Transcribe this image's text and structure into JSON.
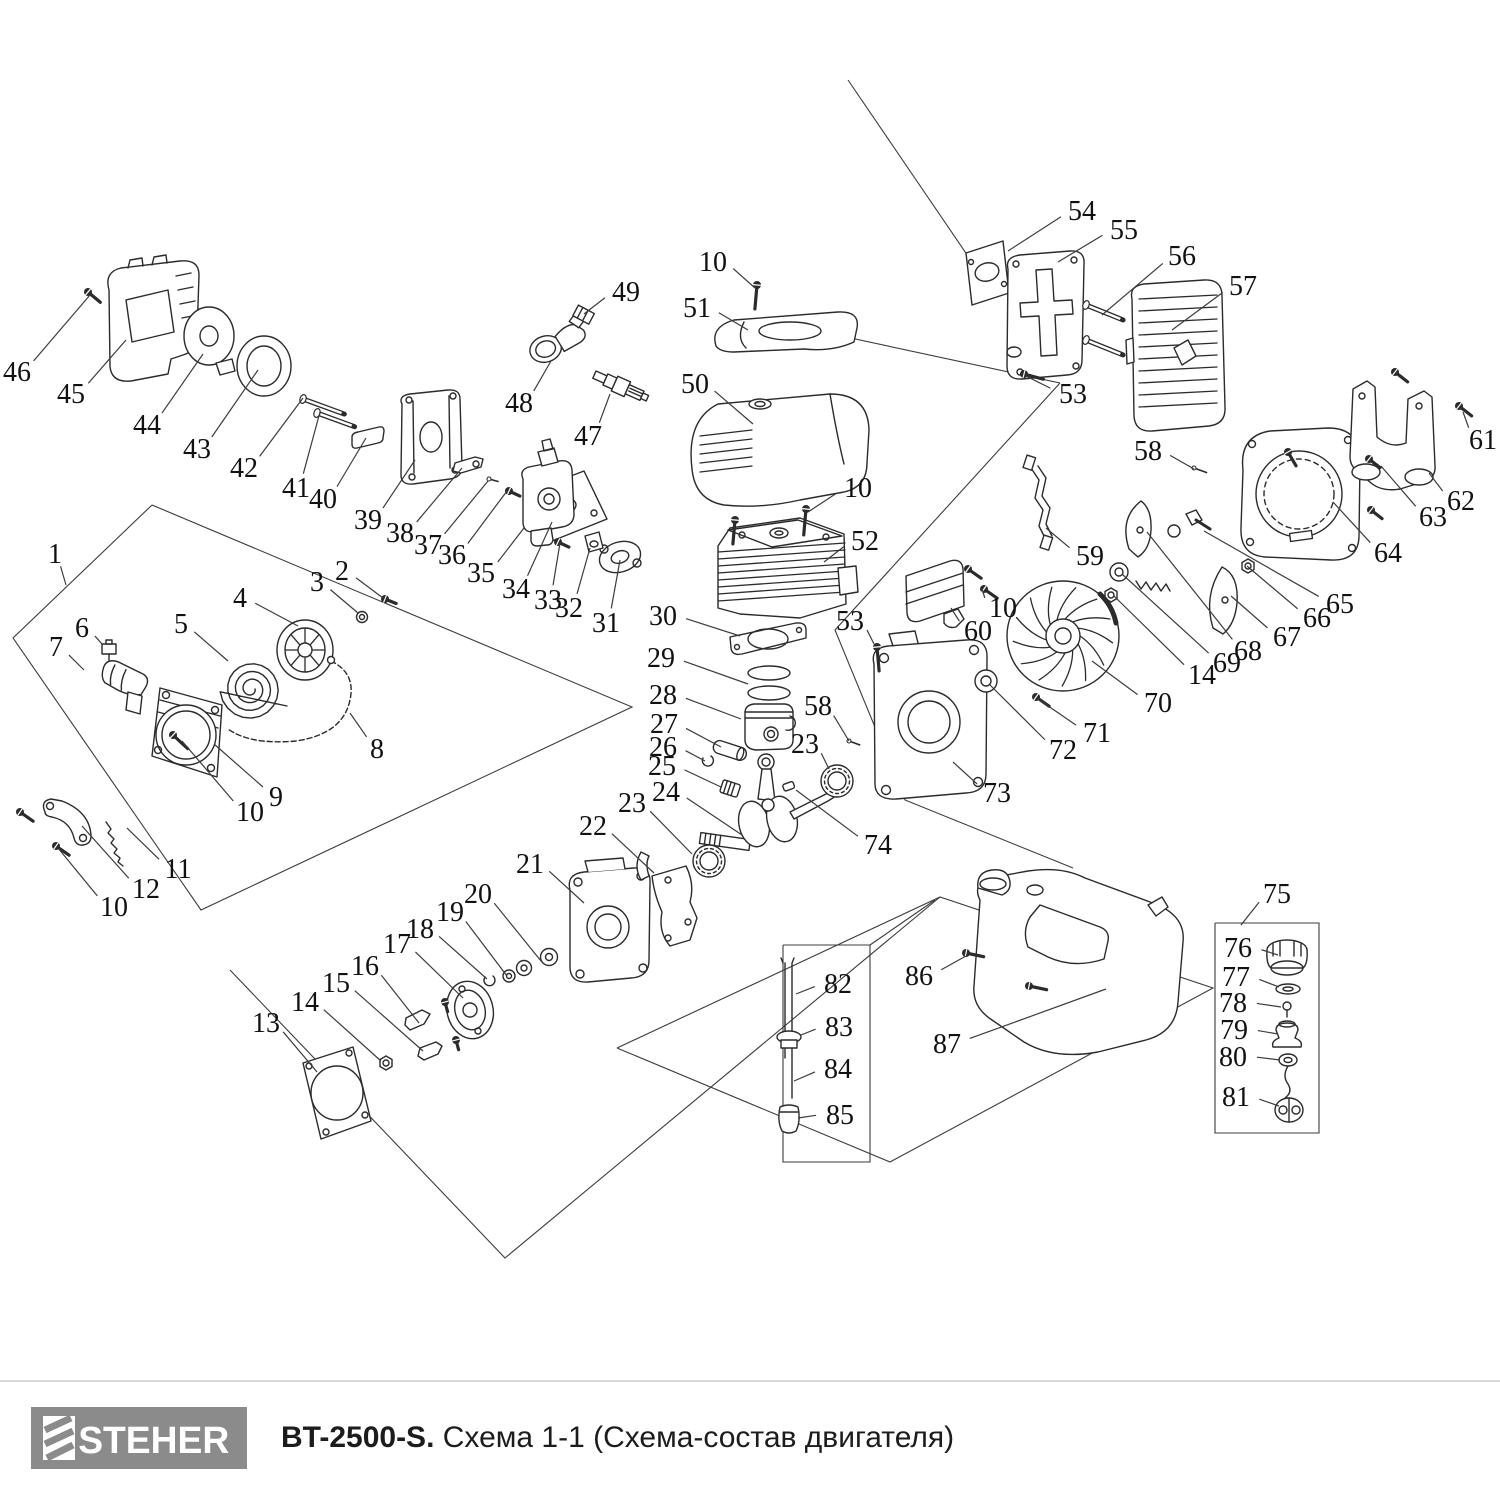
{
  "footer": {
    "brand": "STEHER",
    "model": "BT-2500-S.",
    "scheme": "Схема 1-1 (Схема-состав двигателя)"
  },
  "colors": {
    "ink": "#2b2b2b",
    "leader": "#3c3c3c",
    "logo_gray": "#8b8b8b",
    "divider": "#d9d9d9"
  },
  "diagram": {
    "labels": [
      [
        "46",
        17,
        371,
        90,
        295
      ],
      [
        "45",
        71,
        393,
        126,
        340
      ],
      [
        "44",
        147,
        424,
        203,
        354
      ],
      [
        "43",
        197,
        448,
        258,
        370
      ],
      [
        "42",
        244,
        467,
        303,
        398
      ],
      [
        "41",
        296,
        487,
        320,
        412
      ],
      [
        "40",
        323,
        498,
        366,
        438
      ],
      [
        "39",
        368,
        519,
        415,
        460
      ],
      [
        "38",
        400,
        532,
        462,
        468
      ],
      [
        "37",
        428,
        544,
        488,
        481
      ],
      [
        "36",
        452,
        554,
        507,
        491
      ],
      [
        "35",
        481,
        572,
        524,
        528
      ],
      [
        "34",
        516,
        588,
        552,
        522
      ],
      [
        "33",
        548,
        599,
        560,
        543
      ],
      [
        "32",
        569,
        607,
        590,
        548
      ],
      [
        "31",
        606,
        622,
        620,
        560
      ],
      [
        "1",
        55,
        553,
        66,
        585
      ],
      [
        "49",
        626,
        291,
        584,
        314
      ],
      [
        "48",
        519,
        402,
        551,
        361
      ],
      [
        "47",
        588,
        435,
        610,
        394
      ],
      [
        "10",
        713,
        261,
        755,
        288
      ],
      [
        "51",
        697,
        307,
        748,
        330
      ],
      [
        "50",
        695,
        383,
        753,
        424
      ],
      [
        "10",
        858,
        487,
        808,
        512
      ],
      [
        "52",
        865,
        540,
        824,
        562
      ],
      [
        "54",
        1082,
        210,
        1008,
        251
      ],
      [
        "55",
        1124,
        229,
        1058,
        262
      ],
      [
        "56",
        1182,
        255,
        1102,
        315
      ],
      [
        "57",
        1243,
        285,
        1172,
        330
      ],
      [
        "53",
        1073,
        393,
        1026,
        376
      ],
      [
        "58",
        1148,
        450,
        1194,
        469
      ],
      [
        "61",
        1483,
        439,
        1463,
        412
      ],
      [
        "62",
        1461,
        500,
        1429,
        473
      ],
      [
        "63",
        1433,
        516,
        1381,
        466
      ],
      [
        "64",
        1388,
        552,
        1333,
        502
      ],
      [
        "65",
        1340,
        603,
        1204,
        531
      ],
      [
        "66",
        1317,
        617,
        1247,
        566
      ],
      [
        "67",
        1287,
        636,
        1231,
        596
      ],
      [
        "68",
        1248,
        650,
        1147,
        532
      ],
      [
        "69",
        1227,
        662,
        1122,
        574
      ],
      [
        "14",
        1202,
        674,
        1114,
        596
      ],
      [
        "70",
        1158,
        702,
        1092,
        661
      ],
      [
        "71",
        1097,
        732,
        1038,
        699
      ],
      [
        "72",
        1063,
        749,
        989,
        684
      ],
      [
        "73",
        997,
        792,
        953,
        762
      ],
      [
        "74",
        878,
        844,
        796,
        790
      ],
      [
        "59",
        1090,
        555,
        1046,
        528
      ],
      [
        "60",
        978,
        630,
        951,
        608
      ],
      [
        "10",
        1003,
        607,
        982,
        589
      ],
      [
        "53",
        850,
        620,
        874,
        644
      ],
      [
        "58",
        818,
        705,
        849,
        741
      ],
      [
        "23",
        805,
        743,
        829,
        769
      ],
      [
        "6",
        82,
        627,
        102,
        644
      ],
      [
        "7",
        56,
        646,
        84,
        670
      ],
      [
        "5",
        181,
        623,
        228,
        661
      ],
      [
        "4",
        240,
        597,
        298,
        626
      ],
      [
        "3",
        317,
        581,
        358,
        613
      ],
      [
        "2",
        342,
        570,
        383,
        598
      ],
      [
        "8",
        377,
        748,
        350,
        713
      ],
      [
        "9",
        276,
        796,
        214,
        744
      ],
      [
        "10",
        250,
        811,
        182,
        741
      ],
      [
        "11",
        178,
        868,
        127,
        828
      ],
      [
        "12",
        146,
        888,
        82,
        826
      ],
      [
        "10",
        114,
        906,
        58,
        848
      ],
      [
        "30",
        663,
        615,
        740,
        636
      ],
      [
        "29",
        661,
        657,
        748,
        684
      ],
      [
        "28",
        663,
        694,
        741,
        719
      ],
      [
        "27",
        664,
        723,
        721,
        747
      ],
      [
        "26",
        663,
        746,
        705,
        761
      ],
      [
        "25",
        662,
        765,
        721,
        787
      ],
      [
        "24",
        666,
        791,
        742,
        835
      ],
      [
        "23",
        632,
        802,
        692,
        854
      ],
      [
        "22",
        593,
        825,
        654,
        873
      ],
      [
        "13",
        266,
        1022,
        317,
        1072
      ],
      [
        "14",
        305,
        1001,
        381,
        1061
      ],
      [
        "15",
        336,
        982,
        423,
        1051
      ],
      [
        "16",
        365,
        965,
        419,
        1023
      ],
      [
        "17",
        397,
        943,
        463,
        998
      ],
      [
        "18",
        420,
        928,
        487,
        979
      ],
      [
        "19",
        450,
        911,
        507,
        976
      ],
      [
        "20",
        478,
        893,
        541,
        961
      ],
      [
        "21",
        530,
        863,
        584,
        903
      ],
      [
        "86",
        919,
        975,
        966,
        956
      ],
      [
        "87",
        947,
        1043,
        1106,
        989
      ],
      [
        "82",
        838,
        983,
        796,
        994
      ],
      [
        "83",
        839,
        1026,
        801,
        1035
      ],
      [
        "84",
        838,
        1068,
        794,
        1081
      ],
      [
        "85",
        840,
        1114,
        798,
        1118
      ],
      [
        "75",
        1277,
        893,
        1241,
        925
      ],
      [
        "76",
        1238,
        947,
        1278,
        955
      ],
      [
        "77",
        1236,
        976,
        1279,
        987
      ],
      [
        "78",
        1233,
        1002,
        1281,
        1007
      ],
      [
        "79",
        1234,
        1029,
        1278,
        1034
      ],
      [
        "80",
        1233,
        1056,
        1280,
        1060
      ],
      [
        "81",
        1236,
        1096,
        1279,
        1106
      ]
    ],
    "screws": [
      [
        88,
        292,
        40,
        16,
        "h"
      ],
      [
        303,
        399,
        20,
        44,
        "r"
      ],
      [
        317,
        413,
        20,
        40,
        "r"
      ],
      [
        757,
        285,
        95,
        24,
        "h"
      ],
      [
        806,
        509,
        95,
        26,
        "h"
      ],
      [
        735,
        520,
        95,
        24,
        "h"
      ],
      [
        968,
        569,
        35,
        16,
        "h"
      ],
      [
        984,
        589,
        35,
        16,
        "h"
      ],
      [
        877,
        647,
        85,
        24,
        "h"
      ],
      [
        1024,
        374,
        15,
        20,
        "h"
      ],
      [
        1086,
        305,
        22,
        40,
        "r"
      ],
      [
        1086,
        340,
        22,
        40,
        "r"
      ],
      [
        1194,
        468,
        20,
        14,
        "p"
      ],
      [
        849,
        741,
        20,
        12,
        "p"
      ],
      [
        489,
        479,
        15,
        10,
        "p"
      ],
      [
        509,
        491,
        25,
        12,
        "h"
      ],
      [
        558,
        542,
        25,
        12,
        "h"
      ],
      [
        1395,
        372,
        38,
        16,
        "h"
      ],
      [
        1459,
        406,
        38,
        16,
        "h"
      ],
      [
        1369,
        459,
        38,
        14,
        "h"
      ],
      [
        1371,
        510,
        38,
        14,
        "h"
      ],
      [
        1288,
        452,
        60,
        16,
        "h"
      ],
      [
        1036,
        697,
        35,
        16,
        "h"
      ],
      [
        56,
        846,
        35,
        16,
        "h"
      ],
      [
        20,
        812,
        35,
        16,
        "h"
      ],
      [
        173,
        735,
        43,
        20,
        "h"
      ],
      [
        385,
        599,
        22,
        12,
        "h"
      ],
      [
        966,
        953,
        12,
        18,
        "h"
      ],
      [
        1029,
        986,
        12,
        18,
        "h"
      ],
      [
        445,
        1002,
        75,
        10,
        "h"
      ],
      [
        456,
        1040,
        75,
        10,
        "h"
      ]
    ],
    "panels": [
      [
        [
          152,
          505
        ],
        [
          13,
          638
        ],
        [
          201,
          910
        ],
        [
          632,
          707
        ],
        [
          152,
          505
        ]
      ],
      [
        [
          230,
          970
        ],
        [
          505,
          1258
        ],
        [
          940,
          897
        ]
      ],
      [
        [
          1060,
          383
        ],
        [
          835,
          630
        ],
        [
          905,
          800
        ],
        [
          1073,
          868
        ]
      ],
      [
        [
          848,
          80
        ],
        [
          972,
          262
        ]
      ],
      [
        [
          790,
          325
        ],
        [
          1060,
          383
        ]
      ],
      [
        [
          617,
          1048
        ],
        [
          940,
          897
        ],
        [
          1213,
          988
        ],
        [
          890,
          1162
        ],
        [
          617,
          1048
        ]
      ],
      [
        [
          870,
          945
        ],
        [
          935,
          900
        ]
      ],
      [
        [
          783,
          945
        ],
        [
          870,
          945
        ],
        [
          870,
          1162
        ],
        [
          783,
          1162
        ],
        [
          783,
          945
        ]
      ],
      [
        [
          1215,
          923
        ],
        [
          1319,
          923
        ],
        [
          1319,
          1133
        ],
        [
          1215,
          1133
        ],
        [
          1215,
          923
        ]
      ]
    ]
  }
}
